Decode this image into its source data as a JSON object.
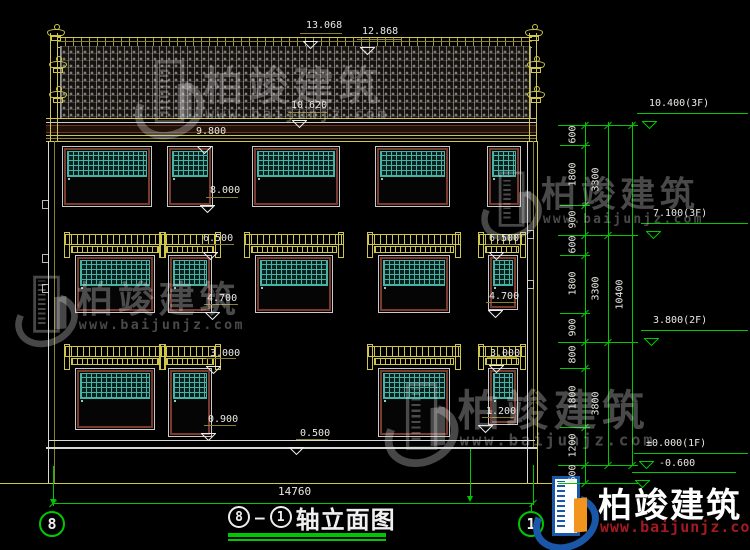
{
  "colors": {
    "line_yellow": "#cfc64a",
    "line_olive": "#8a7f33",
    "line_green": "#00c800",
    "lattice_teal": "#45b3a5",
    "pane_teal": "#8fcac0",
    "frame_maroon": "#7a3b2e",
    "text": "#e9e9e4",
    "logo_blue": "#1a57a8",
    "logo_orange": "#f2951f",
    "url_red": "#a51a20"
  },
  "title_block": {
    "axis_from": "8",
    "dash": "–",
    "axis_to": "1",
    "title": "轴立面图",
    "total_dim": "14760"
  },
  "axis_bubbles": {
    "left": "8",
    "right": "1"
  },
  "logo": {
    "name": "柏竣建筑",
    "url": "www.baijunjz.com"
  },
  "watermark": {
    "name": "柏竣建筑",
    "url": "www.baijunjz.com"
  },
  "watermarks": [
    {
      "x": 138,
      "y": 54,
      "scale": 1.05
    },
    {
      "x": 484,
      "y": 166,
      "scale": 0.92
    },
    {
      "x": 18,
      "y": 270,
      "scale": 0.95
    },
    {
      "x": 388,
      "y": 376,
      "scale": 1.12
    }
  ],
  "markers": [
    {
      "t": "13.068",
      "tx": 306,
      "ty": 20,
      "lx": 300,
      "lw": 42,
      "ly": 33,
      "ax": 303,
      "v": "b"
    },
    {
      "t": "12.868",
      "tx": 362,
      "ty": 26,
      "lx": 357,
      "lw": 44,
      "ly": 39,
      "ax": 360,
      "v": "b"
    },
    {
      "t": "10.620",
      "tx": 291,
      "ty": 100,
      "lx": 288,
      "lw": 40,
      "ly": 112,
      "ax": 292,
      "v": "b"
    },
    {
      "t": "9.800",
      "tx": 196,
      "ty": 126,
      "lx": 192,
      "lw": 38,
      "ly": 138,
      "ax": 197,
      "v": "b"
    },
    {
      "t": "8.000",
      "tx": 210,
      "ty": 185,
      "lx": 206,
      "lw": 32,
      "ly": 197,
      "ax": 200,
      "v": "b"
    },
    {
      "t": "6.500",
      "tx": 203,
      "ty": 233,
      "lx": 200,
      "lw": 34,
      "ly": 244,
      "ax": 203,
      "v": "b"
    },
    {
      "t": "6.500",
      "tx": 489,
      "ty": 233,
      "lx": 486,
      "lw": 32,
      "ly": 244,
      "ax": 489,
      "v": "b"
    },
    {
      "t": "4.700",
      "tx": 207,
      "ty": 293,
      "lx": 204,
      "lw": 34,
      "ly": 304,
      "ax": 205,
      "v": "b"
    },
    {
      "t": "4.700",
      "tx": 489,
      "ty": 291,
      "lx": 486,
      "lw": 30,
      "ly": 302,
      "ax": 488,
      "v": "b"
    },
    {
      "t": "3.000",
      "tx": 210,
      "ty": 348,
      "lx": 206,
      "lw": 30,
      "ly": 358,
      "ax": 206,
      "v": "b"
    },
    {
      "t": "3.000",
      "tx": 490,
      "ty": 348,
      "lx": 487,
      "lw": 30,
      "ly": 357,
      "ax": 489,
      "v": "b"
    },
    {
      "t": "0.900",
      "tx": 208,
      "ty": 414,
      "lx": 204,
      "lw": 32,
      "ly": 425,
      "ax": 201,
      "v": "b"
    },
    {
      "t": "1.200",
      "tx": 486,
      "ty": 406,
      "lx": 482,
      "lw": 32,
      "ly": 417,
      "ax": 478,
      "v": "b"
    },
    {
      "t": "0.500",
      "tx": 300,
      "ty": 428,
      "lx": 296,
      "lw": 32,
      "ly": 439,
      "ax": 289,
      "v": "b"
    },
    {
      "t": "10.400(3F)",
      "tx": 649,
      "ty": 98,
      "lx": 637,
      "lw": 111,
      "ly": 113,
      "ax": 642,
      "v": "g"
    },
    {
      "t": "7.100(3F)",
      "tx": 653,
      "ty": 208,
      "lx": 641,
      "lw": 107,
      "ly": 223,
      "ax": 646,
      "v": "g"
    },
    {
      "t": "3.800(2F)",
      "tx": 653,
      "ty": 315,
      "lx": 641,
      "lw": 107,
      "ly": 330,
      "ax": 644,
      "v": "g"
    },
    {
      "t": "±0.000(1F)",
      "tx": 646,
      "ty": 438,
      "lx": 634,
      "lw": 114,
      "ly": 453,
      "ax": 639,
      "v": "g"
    },
    {
      "t": "-0.600",
      "tx": 659,
      "ty": 458,
      "lx": 632,
      "lw": 104,
      "ly": 472,
      "ax": 635,
      "v": "g"
    }
  ],
  "right_chain": {
    "vlines": [
      [
        585,
        122,
        484
      ],
      [
        608,
        122,
        466
      ],
      [
        632,
        122,
        466
      ]
    ],
    "ext_major": [
      125,
      235,
      342,
      465,
      483
    ],
    "ext_minor": [
      145,
      205,
      255,
      313,
      368,
      427
    ],
    "ticks1": [
      125,
      145,
      205,
      235,
      255,
      313,
      342,
      368,
      427,
      465,
      483
    ],
    "ticks2": [
      125,
      235,
      342,
      465
    ],
    "ticks3": [
      125,
      465
    ],
    "col1": {
      "x": 573,
      "labels": [
        [
          "600",
          125,
          145
        ],
        [
          "1800",
          145,
          205
        ],
        [
          "900",
          205,
          235
        ],
        [
          "600",
          235,
          255
        ],
        [
          "1800",
          255,
          313
        ],
        [
          "900",
          313,
          342
        ],
        [
          "800",
          342,
          368
        ],
        [
          "1800",
          368,
          427
        ],
        [
          "1200",
          427,
          465
        ],
        [
          "600",
          465,
          483
        ]
      ]
    },
    "col2": {
      "x": 596,
      "labels": [
        [
          "3300",
          125,
          235
        ],
        [
          "3300",
          235,
          342
        ],
        [
          "3800",
          342,
          465
        ]
      ]
    },
    "col3": {
      "x": 620,
      "labels": [
        [
          "10400",
          125,
          465
        ]
      ]
    }
  },
  "building": {
    "windows": [
      {
        "x": 62,
        "y": 146,
        "w": 90,
        "h": 61,
        "panes": 3,
        "canopy": null
      },
      {
        "x": 167,
        "y": 146,
        "w": 46,
        "h": 61,
        "panes": 2,
        "canopy": null
      },
      {
        "x": 252,
        "y": 146,
        "w": 88,
        "h": 61,
        "panes": 3,
        "canopy": null
      },
      {
        "x": 375,
        "y": 146,
        "w": 75,
        "h": 61,
        "panes": 3,
        "canopy": null
      },
      {
        "x": 487,
        "y": 146,
        "w": 34,
        "h": 61,
        "panes": 1,
        "canopy": null
      },
      {
        "x": 75,
        "y": 255,
        "w": 80,
        "h": 58,
        "panes": 3,
        "canopy": [
          64,
          232,
          102
        ]
      },
      {
        "x": 168,
        "y": 255,
        "w": 44,
        "h": 58,
        "panes": 2,
        "canopy": [
          159,
          232,
          62
        ]
      },
      {
        "x": 255,
        "y": 255,
        "w": 78,
        "h": 58,
        "panes": 3,
        "canopy": [
          244,
          232,
          100
        ]
      },
      {
        "x": 378,
        "y": 255,
        "w": 72,
        "h": 58,
        "panes": 3,
        "canopy": [
          367,
          232,
          94
        ]
      },
      {
        "x": 488,
        "y": 255,
        "w": 30,
        "h": 55,
        "panes": 1,
        "canopy": [
          478,
          232,
          48
        ]
      },
      {
        "x": 75,
        "y": 368,
        "w": 80,
        "h": 62,
        "panes": 3,
        "canopy": [
          64,
          344,
          102
        ]
      },
      {
        "x": 168,
        "y": 368,
        "w": 44,
        "h": 69,
        "panes": 2,
        "canopy": [
          159,
          344,
          62
        ]
      },
      {
        "x": 378,
        "y": 368,
        "w": 72,
        "h": 69,
        "panes": 3,
        "canopy": [
          367,
          344,
          94
        ]
      },
      {
        "x": 488,
        "y": 368,
        "w": 30,
        "h": 57,
        "panes": 1,
        "canopy": [
          478,
          344,
          48
        ]
      }
    ],
    "finials": [
      [
        46,
        24
      ],
      [
        48,
        56
      ],
      [
        48,
        86
      ],
      [
        524,
        24
      ],
      [
        526,
        56
      ],
      [
        526,
        86
      ]
    ],
    "wall_marks": [
      [
        42,
        200
      ],
      [
        42,
        254
      ],
      [
        42,
        284
      ],
      [
        527,
        230
      ],
      [
        527,
        280
      ]
    ]
  },
  "base": {
    "dim_line": [
      53,
      503,
      480
    ],
    "dim_ticks": [
      [
        53,
        503
      ],
      [
        533,
        503
      ]
    ],
    "vlines": [
      [
        53,
        466,
        40
      ],
      [
        470,
        449,
        51
      ],
      [
        533,
        465,
        40
      ],
      [
        531,
        503,
        9
      ]
    ],
    "arrows": [
      [
        53,
        499
      ],
      [
        470,
        496
      ]
    ]
  }
}
